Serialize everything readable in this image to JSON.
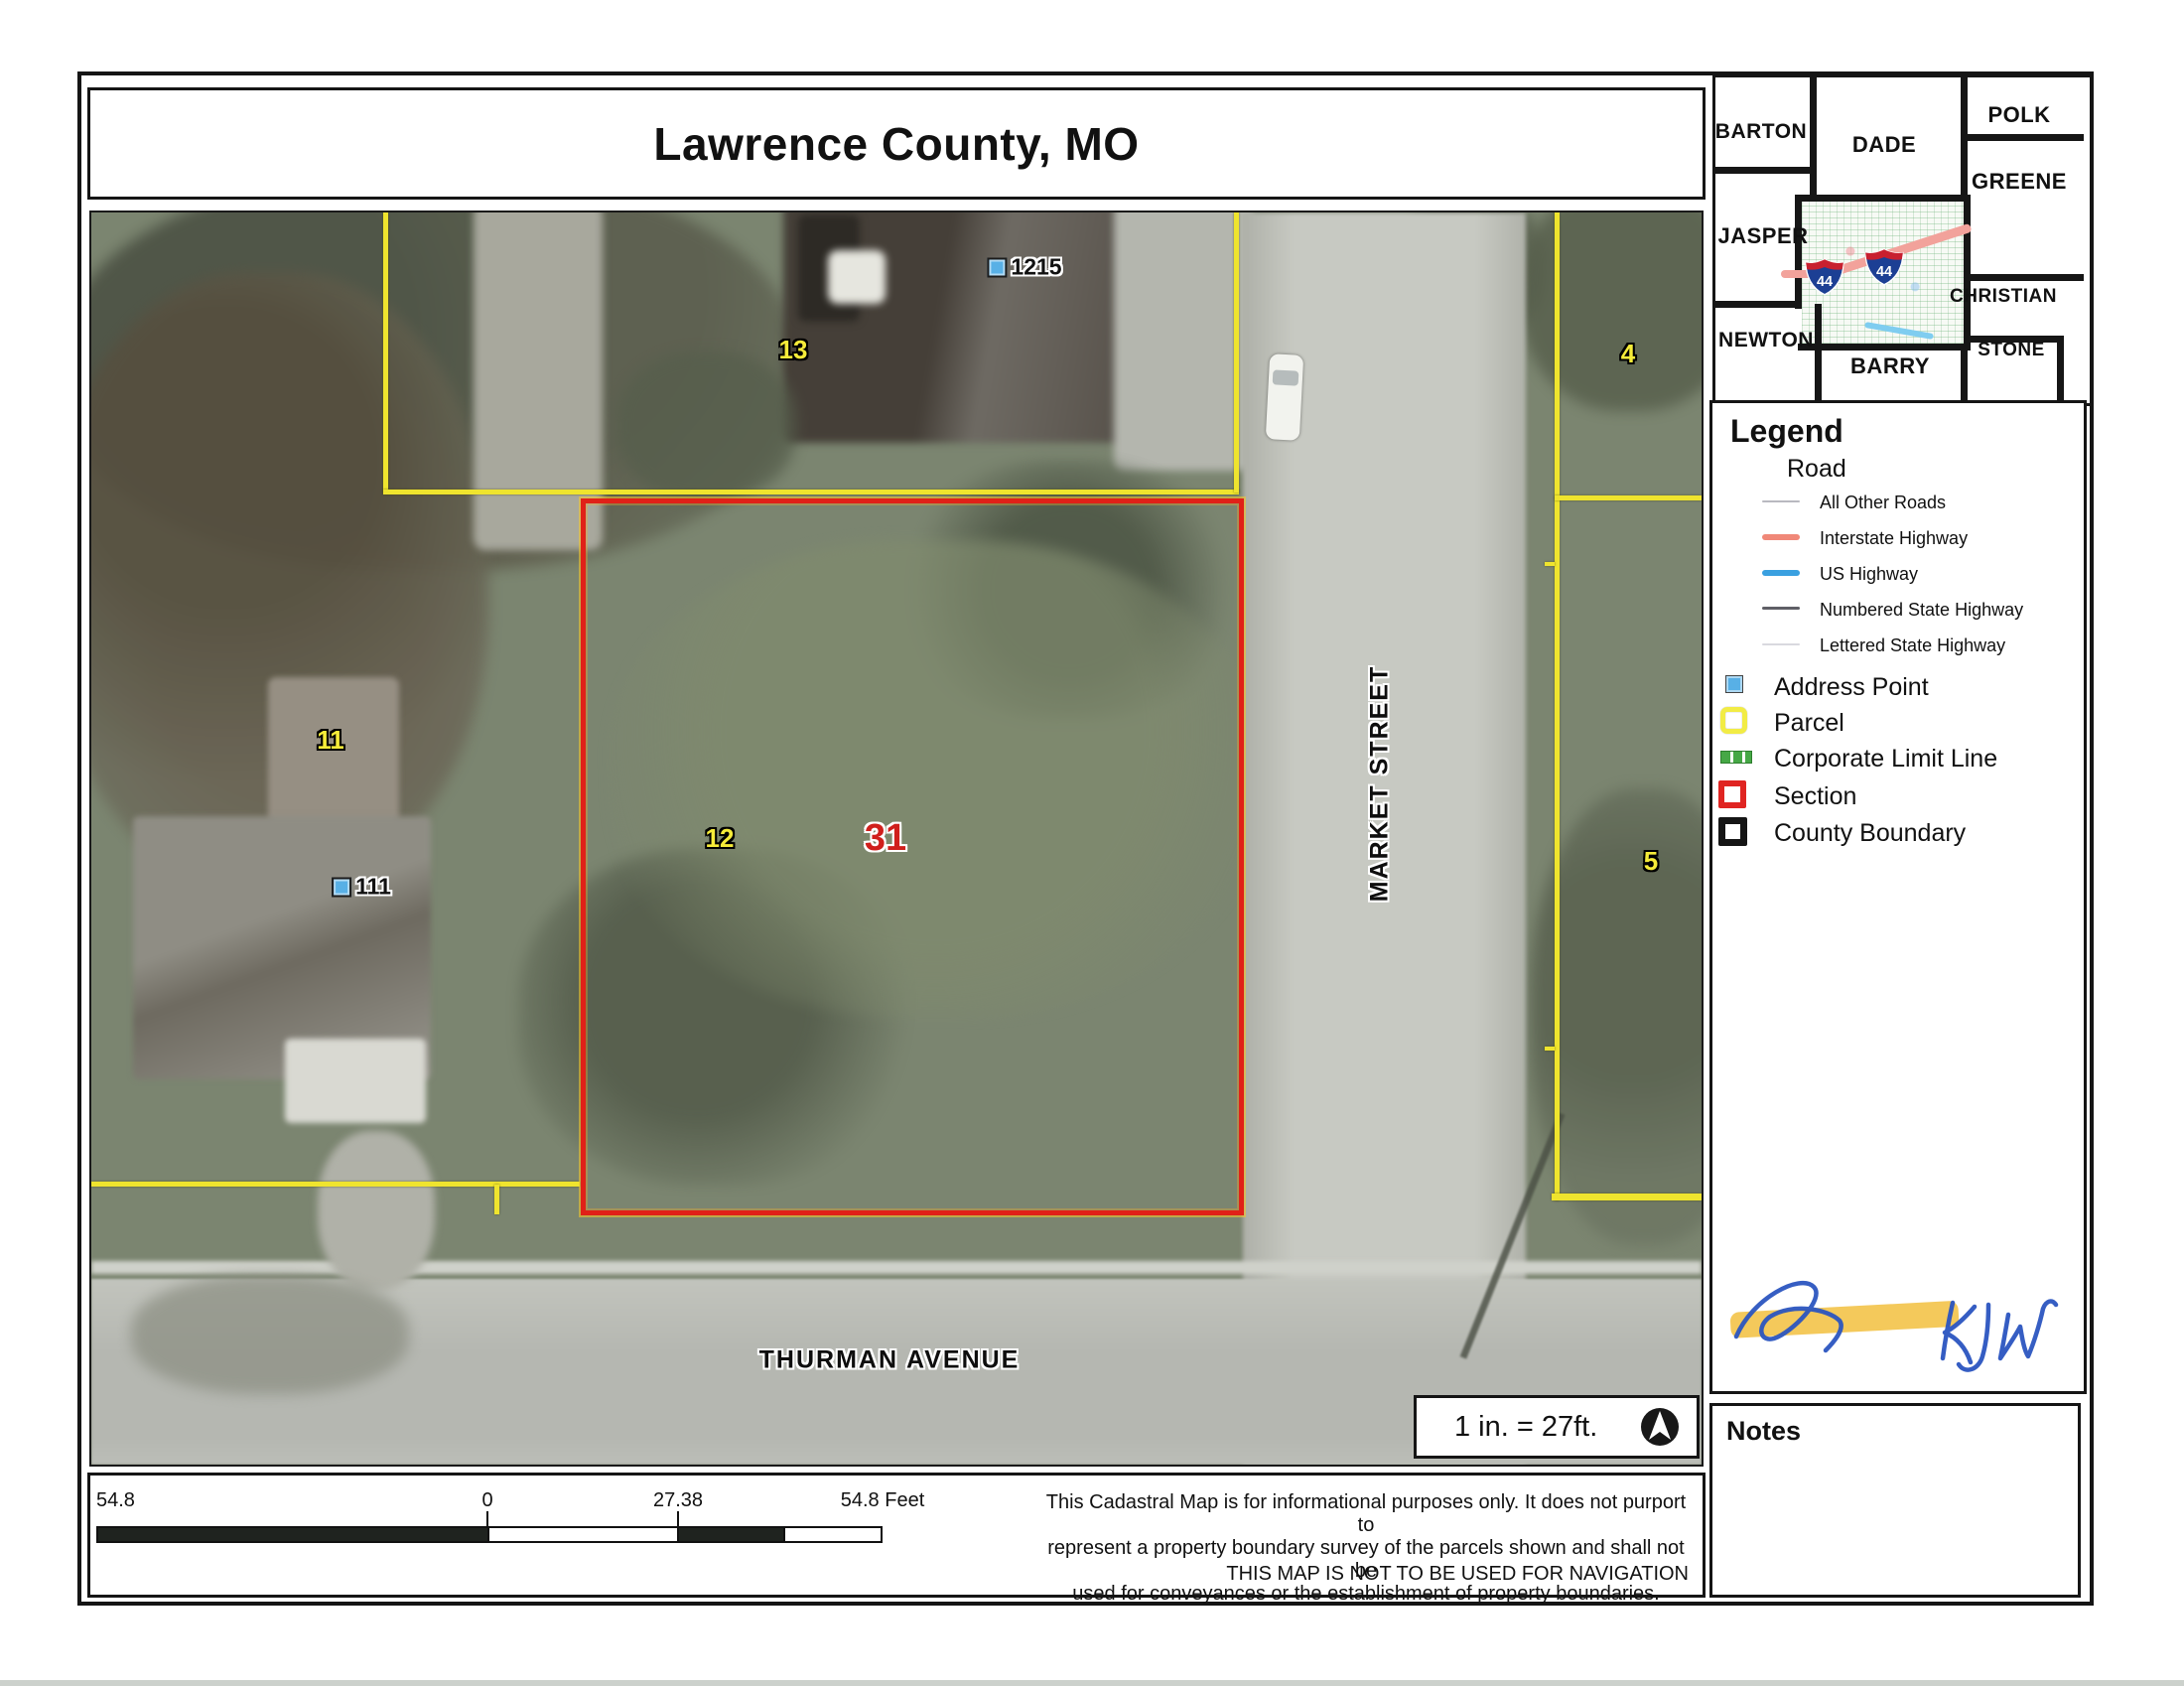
{
  "title": "Lawrence County, MO",
  "locator": {
    "counties": [
      "BARTON",
      "DADE",
      "POLK",
      "GREENE",
      "JASPER",
      "CHRISTIAN",
      "NEWTON",
      "BARRY",
      "STONE"
    ],
    "shields": [
      "44",
      "44"
    ]
  },
  "legend": {
    "heading": "Legend",
    "road": {
      "label": "Road",
      "items": [
        {
          "label": "All Other Roads",
          "color": "#b9b9c0"
        },
        {
          "label": "Interstate Highway",
          "color": "#f08878"
        },
        {
          "label": "US Highway",
          "color": "#3aa0e0"
        },
        {
          "label": "Numbered State Highway",
          "color": "#5f5f66"
        },
        {
          "label": "Lettered State Highway",
          "color": "#d9d9df"
        }
      ]
    },
    "items": [
      {
        "label": "Address Point",
        "color": "#58b0e6"
      },
      {
        "label": "Parcel",
        "color": "#f2ec45"
      },
      {
        "label": "Corporate Limit Line",
        "color": "#46a846"
      },
      {
        "label": "Section",
        "color": "#e02522"
      },
      {
        "label": "County Boundary",
        "color": "#151515"
      }
    ]
  },
  "map": {
    "parcel_labels": [
      {
        "text": "13"
      },
      {
        "text": "4"
      },
      {
        "text": "11"
      },
      {
        "text": "12"
      },
      {
        "text": "5"
      }
    ],
    "section_label": "31",
    "address_points": [
      {
        "text": "1215"
      },
      {
        "text": "111"
      }
    ],
    "streets": [
      {
        "text": "MARKET STREET"
      },
      {
        "text": "THURMAN AVENUE"
      }
    ]
  },
  "scale_note": "1 in. = 27ft.",
  "scale_bar": {
    "start": "54.8",
    "zero": "0",
    "mid": "27.38",
    "end": "54.8 Feet"
  },
  "disclaimer": {
    "lines": [
      "This Cadastral Map is for informational purposes only.  It does not purport to",
      "represent a property boundary survey of the parcels shown and shall not be",
      "used for conveyances or the establishment of property boundaries."
    ],
    "warning": "THIS MAP IS NOT TO BE USED FOR NAVIGATION"
  },
  "notes_heading": "Notes",
  "signature_initials": "KJW",
  "colors": {
    "parcel_yellow": "#efe42e",
    "section_red": "#e02118",
    "address_blue": "#58b0e6",
    "highlighter": "#f3c349",
    "signature_ink": "#2b55c0"
  }
}
